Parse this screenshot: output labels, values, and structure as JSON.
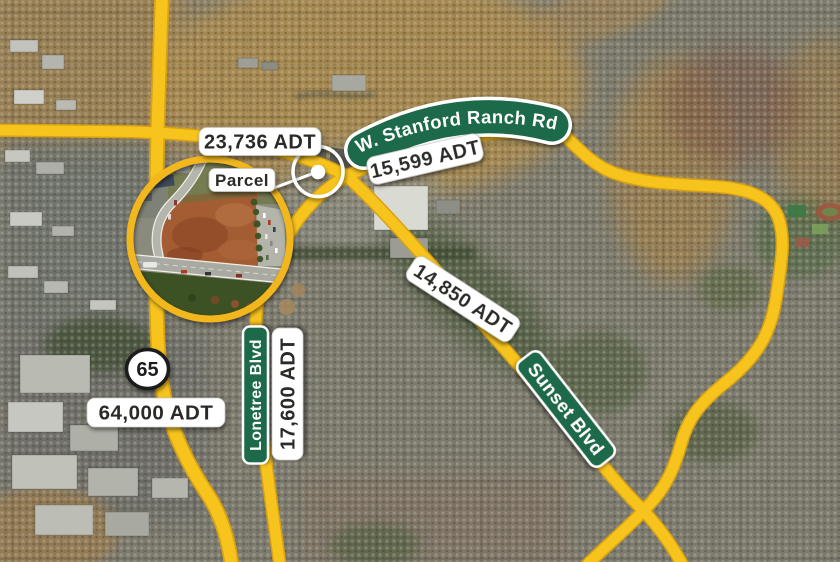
{
  "signs": {
    "stanford_ranch": "W. Stanford Ranch Rd",
    "sunset": "Sunset Blvd",
    "lonetree": "Lonetree Blvd",
    "route_65": "65"
  },
  "traffic": {
    "stanford_west": "23,736 ADT",
    "stanford_east": "15,599 ADT",
    "sunset": "14,850 ADT",
    "lonetree": "17,600 ADT",
    "route_65": "64,000 ADT"
  },
  "callout": {
    "parcel_label": "Parcel"
  },
  "colors": {
    "road_fill": "#F7C41E",
    "road_casing": "#D8A111",
    "sign_green": "#1E6B48",
    "sign_border": "#FFFFFF",
    "label_bg": "#FFFFFF",
    "label_text": "#2B2A28",
    "callout_white": "#FFFFFF",
    "inset_ring": "#F2B71C",
    "parcel_dirt": "#A45C33"
  }
}
